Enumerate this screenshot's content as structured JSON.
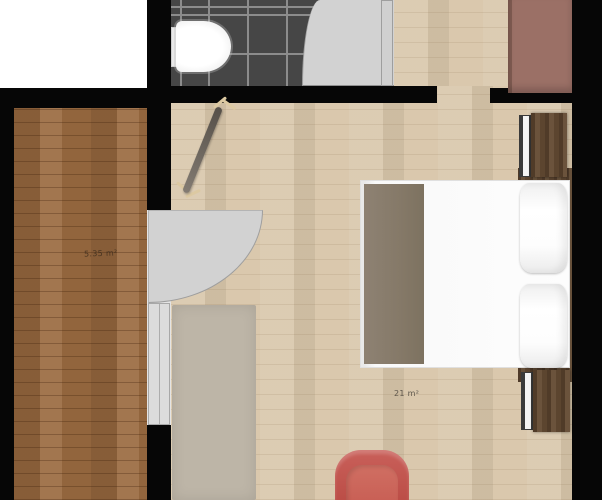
{
  "plan": {
    "type": "floor-plan",
    "rooms": {
      "hallway": {
        "area_label": "5.35 m²",
        "floor": "dark wood planks"
      },
      "bedroom": {
        "area_label": "21 m²",
        "floor": "light wood planks"
      },
      "bathroom": {
        "area_label": "",
        "floor": "dark gray tiles with light grout grid"
      }
    },
    "objects": [
      "toilet",
      "bathroom-door",
      "bedroom-door",
      "wardrobe",
      "coat-rack",
      "rug",
      "bed",
      "blanket",
      "headboard",
      "pillow",
      "pillow",
      "nightstand",
      "nightstand",
      "radiator",
      "radiator",
      "armchair"
    ],
    "colors": {
      "wall": "#060606",
      "outside": "#ffffff",
      "bedroom_floor": "#d8c6aa",
      "hallway_floor": "#9a6a40",
      "bathroom_tile": "#464646",
      "tile_grout": "#8c8c8c",
      "door_swing": "#d2d2d2",
      "rug": "#bdb5a7",
      "bed": "#fbfbfb",
      "blanket": "#857968",
      "wood_furniture": "#5c452f",
      "wardrobe": "#9b7066",
      "armchair": "#bf5148",
      "label_text": "#3e2d1d"
    }
  }
}
